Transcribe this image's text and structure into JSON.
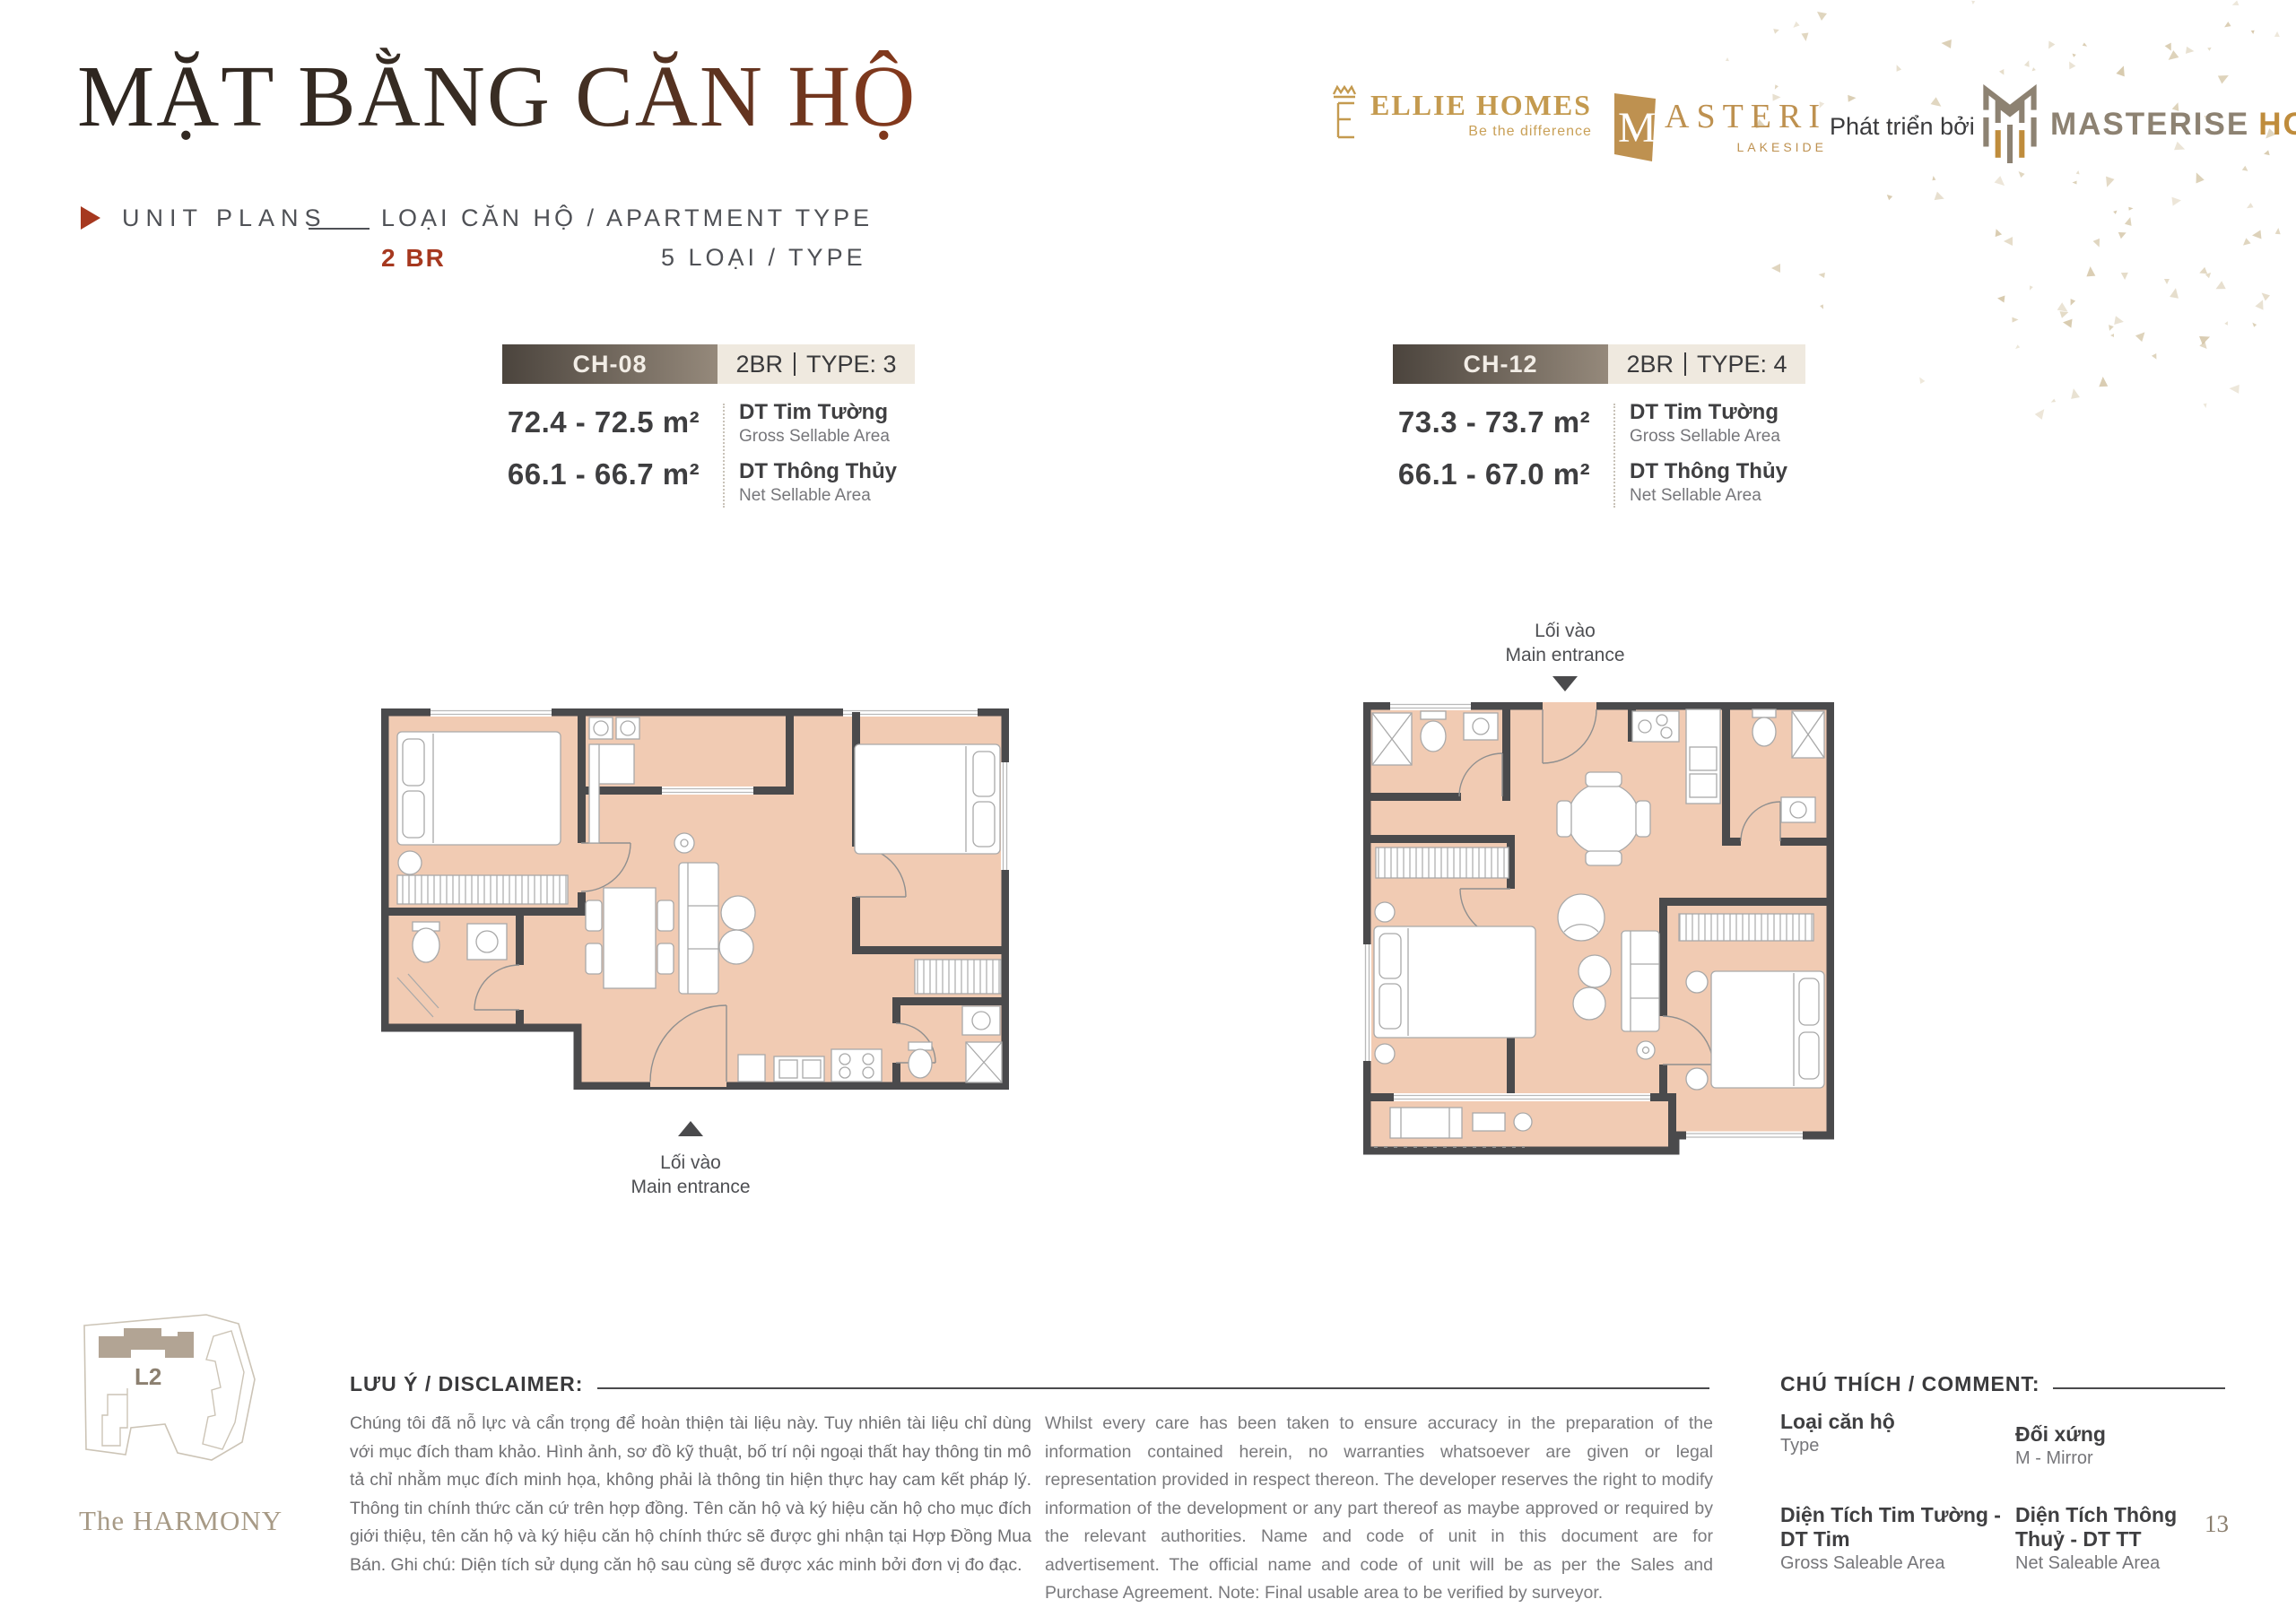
{
  "page": {
    "page_number": "13",
    "project_name": "The HARMONY",
    "building_label": "L2"
  },
  "header": {
    "title": "MẶT BẰNG CĂN HỘ",
    "section_label": "UNIT PLANS",
    "subtitle": "LOẠI CĂN HỘ / APARTMENT TYPE",
    "bedroom_type": "2 BR",
    "type_count": "5 LOẠI / TYPE"
  },
  "logos": {
    "ellie_homes": {
      "name": "ELLIE HOMES",
      "tagline": "Be the difference"
    },
    "masteri": {
      "name": "ASTERI",
      "initial": "M",
      "subname": "LAKESIDE"
    },
    "developer_prefix": "Phát triển bởi",
    "masterise": {
      "name_primary": "MASTERISE",
      "name_secondary": "HOMES"
    }
  },
  "units": [
    {
      "code": "CH-08",
      "type_label": "2BR",
      "type_number": "TYPE: 3",
      "gross_area": "72.4 - 72.5 m²",
      "net_area": "66.1 - 66.7 m²",
      "gross_label_vi": "DT Tim Tường",
      "gross_label_en": "Gross Sellable Area",
      "net_label_vi": "DT Thông Thủy",
      "net_label_en": "Net Sellable Area",
      "entrance_label_vi": "Lối vào",
      "entrance_label_en": "Main entrance"
    },
    {
      "code": "CH-12",
      "type_label": "2BR",
      "type_number": "TYPE: 4",
      "gross_area": "73.3 - 73.7 m²",
      "net_area": "66.1 - 67.0 m²",
      "gross_label_vi": "DT Tim Tường",
      "gross_label_en": "Gross Sellable Area",
      "net_label_vi": "DT Thông Thủy",
      "net_label_en": "Net Sellable Area",
      "entrance_label_vi": "Lối vào",
      "entrance_label_en": "Main entrance"
    }
  ],
  "footer": {
    "disclaimer_title": "LƯU Ý / DISCLAIMER:",
    "disclaimer_vi": "Chúng tôi đã nỗ lực và cẩn trọng để hoàn thiện tài liệu này. Tuy nhiên tài liệu chỉ dùng với mục đích tham khảo. Hình ảnh, sơ đồ kỹ thuật, bố trí nội ngoại thất hay thông tin mô tả chỉ nhằm mục đích minh họa, không phải là thông tin hiện thực hay cam kết pháp lý. Thông tin chính thức căn cứ trên hợp đồng. Tên căn hộ và ký hiệu căn hộ cho mục đích giới thiệu, tên căn hộ và ký hiệu căn hộ chính thức sẽ được ghi nhận tại Hợp Đồng Mua Bán. Ghi chú: Diện tích sử dụng căn hộ sau cùng sẽ được xác minh bởi đơn vị đo đạc.",
    "disclaimer_en": "Whilst every care has been taken to ensure accuracy in the preparation of the information contained herein, no warranties whatsoever are given or legal representation provided in respect thereon. The developer reserves the right to modify information of the development or any part thereof as maybe approved or required by the relevant authorities. Name and code of unit in this document are for advertisement. The official name and code of unit will be as per the Sales and Purchase Agreement. Note: Final usable area to be verified by surveyor.",
    "comment_title": "CHÚ THÍCH / COMMENT:",
    "legend": [
      {
        "vi": "Loại căn hộ",
        "en": "Type"
      },
      {
        "vi": "Đối xứng",
        "en": "M - Mirror"
      },
      {
        "vi": "Diện Tích Tim Tường - DT Tim",
        "en": "Gross Saleable Area"
      },
      {
        "vi": "Diện Tích Thông Thuỷ - DT TT",
        "en": "Net Saleable Area"
      }
    ]
  },
  "colors": {
    "accent": "#A6381F",
    "gold": "#C49A4F",
    "taupe": "#8D8272",
    "wall": "#4A4A4C",
    "plan_fill": "#F1CBB3"
  }
}
